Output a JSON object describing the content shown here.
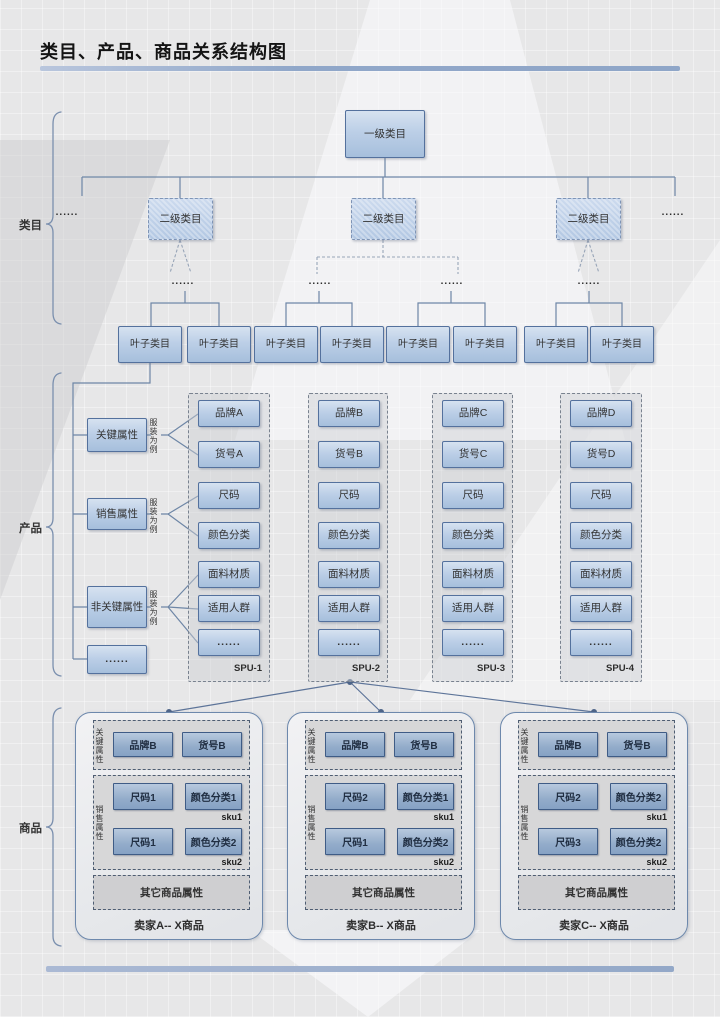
{
  "title": "类目、产品、商品关系结构图",
  "side_labels": {
    "category": "类目",
    "product": "产品",
    "goods": "商品"
  },
  "ellipsis": "......",
  "category": {
    "root": "一级类目",
    "level2": [
      "二级类目",
      "二级类目",
      "二级类目"
    ],
    "leaves": [
      "叶子类目",
      "叶子类目",
      "叶子类目",
      "叶子类目",
      "叶子类目",
      "叶子类目",
      "叶子类目",
      "叶子类目"
    ]
  },
  "product": {
    "attr_groups": [
      "关键属性",
      "销售属性",
      "非关键属性",
      "......"
    ],
    "example_note": "服装为例",
    "spus": [
      {
        "label": "SPU-1",
        "rows": [
          "品牌A",
          "货号A",
          "尺码",
          "颜色分类",
          "面料材质",
          "适用人群",
          "......"
        ]
      },
      {
        "label": "SPU-2",
        "rows": [
          "品牌B",
          "货号B",
          "尺码",
          "颜色分类",
          "面料材质",
          "适用人群",
          "......"
        ]
      },
      {
        "label": "SPU-3",
        "rows": [
          "品牌C",
          "货号C",
          "尺码",
          "颜色分类",
          "面料材质",
          "适用人群",
          "......"
        ]
      },
      {
        "label": "SPU-4",
        "rows": [
          "品牌D",
          "货号D",
          "尺码",
          "颜色分类",
          "面料材质",
          "适用人群",
          "......"
        ]
      }
    ]
  },
  "goods": {
    "key_attr_label": "关键属性",
    "sales_attr_label": "销售属性",
    "sellers": [
      {
        "name": "卖家A-- X商品",
        "brand": "品牌B",
        "item": "货号B",
        "sku1": {
          "size": "尺码1",
          "color": "颜色分类1",
          "tag": "sku1"
        },
        "sku2": {
          "size": "尺码1",
          "color": "颜色分类2",
          "tag": "sku2"
        },
        "other": "其它商品属性"
      },
      {
        "name": "卖家B-- X商品",
        "brand": "品牌B",
        "item": "货号B",
        "sku1": {
          "size": "尺码2",
          "color": "颜色分类1",
          "tag": "sku1"
        },
        "sku2": {
          "size": "尺码1",
          "color": "颜色分类2",
          "tag": "sku2"
        },
        "other": "其它商品属性"
      },
      {
        "name": "卖家C-- X商品",
        "brand": "品牌B",
        "item": "货号B",
        "sku1": {
          "size": "尺码2",
          "color": "颜色分类2",
          "tag": "sku1"
        },
        "sku2": {
          "size": "尺码3",
          "color": "颜色分类2",
          "tag": "sku2"
        },
        "other": "其它商品属性"
      }
    ]
  },
  "colors": {
    "accent_bar": "#90a7c9",
    "node_fill_top": "#d6e2f0",
    "node_fill_bottom": "#a6bfdc",
    "node_border": "#54719d",
    "connector": "#6e86a6",
    "seller_node_fill": "#93acca",
    "background": "#e7e7e8"
  }
}
